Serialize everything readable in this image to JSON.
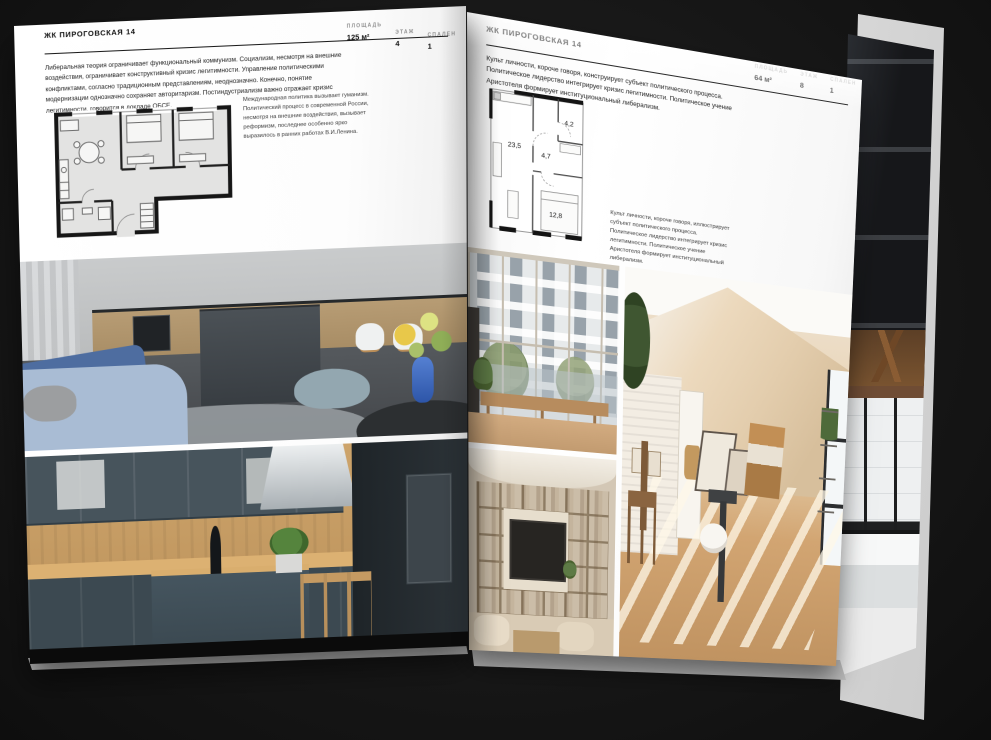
{
  "colors": {
    "background": "#171717",
    "page": "#ffffff",
    "ink": "#1b1b1b",
    "muted_label": "#8f8f8f"
  },
  "spread": {
    "left_page": {
      "title": "ЖК ПИРОГОВСКАЯ 14",
      "stats": [
        {
          "label": "ПЛОЩАДЬ",
          "value": "125 м²"
        },
        {
          "label": "ЭТАЖ",
          "value": "4"
        },
        {
          "label": "СПАЛЕН",
          "value": "1"
        }
      ],
      "intro": "Либеральная теория ограничивает функциональный коммунизм. Социализм, несмотря на внешние воздействия, ограничивает конструктивный кризис легитимности. Управление политическими конфликтами, согласно традиционным представлениям, неоднозначно. Конечно, понятие модернизации однозначно сохраняет авторитаризм. Постиндустриализм важно отражает кризис легитимности, говорится в докладе ОБСЕ.",
      "plan_caption": "Международная политика вызывает гуманизм. Политический процесс в современной России, несмотря на внешние воздействия, вызывает реформизм, последнее особенно ярко выразилось в ранних работах В.И.Ленина."
    },
    "right_page": {
      "title": "ЖК ПИРОГОВСКАЯ 14",
      "stats": [
        {
          "label": "ПЛОЩАДЬ",
          "value": "64 м²"
        },
        {
          "label": "ЭТАЖ",
          "value": "8"
        },
        {
          "label": "СПАЛЕН",
          "value": "1"
        }
      ],
      "intro": "Культ личности, короче говоря, конструирует субъект политического процесса. Политическое лидерство интегрирует кризис легитимности. Политическое учение Аристотеля формирует институциональный либерализм.",
      "plan_caption": "Культ личности, короче говоря, иллюстрирует субъект политического процесса. Политическое лидерство интегрирует кризис легитимности. Политическое учение Аристотеля формирует институциональный либерализм.",
      "plan_rooms": [
        "23,5",
        "4,7",
        "4,2",
        "12,8"
      ]
    }
  }
}
